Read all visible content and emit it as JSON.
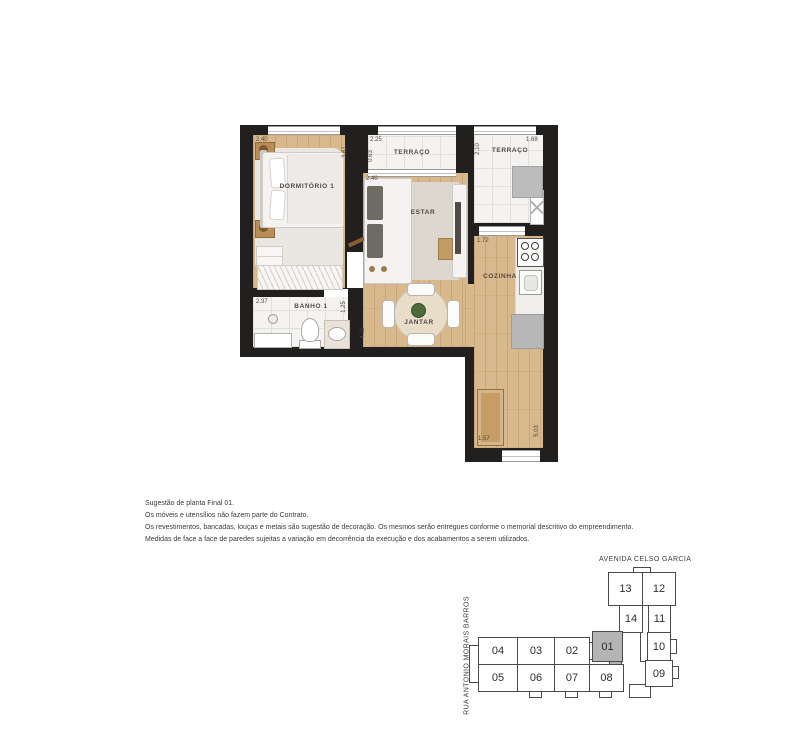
{
  "floor_plan": {
    "rooms": [
      "DORMITÓRIO 1",
      "TERRAÇO",
      "TERRAÇO",
      "ESTAR",
      "COZINHA",
      "BANHO 1",
      "JANTAR"
    ],
    "dimensions": [
      "2.40",
      "3.61",
      "2.25",
      "0.63",
      "2.40",
      "2.10",
      "1.68",
      "1.72",
      "2.37",
      "1.25",
      "4.11",
      "1.57",
      "5.03"
    ]
  },
  "disclaimer": {
    "lines": [
      "Sugestão de planta Final 01.",
      "Os móveis e utensílios não fazem parte do Contrato.",
      "Os revestimentos, bancadas, louças e metais são sugestão de decoração. Os mesmos serão entregues conforme o memorial descritivo do empreendimento.",
      "Medidas de face a face de paredes sujeitas a variação em decorrência da execução e dos acabamentos a serem utilizados."
    ]
  },
  "key_plan": {
    "street_top": "AVENIDA CELSO GARCIA",
    "street_left": "RUA ANTONIO MORAIS BARROS",
    "highlighted_unit": "01",
    "units": [
      "13",
      "12",
      "14",
      "11",
      "01",
      "10",
      "04",
      "03",
      "02",
      "05",
      "06",
      "07",
      "08",
      "09"
    ]
  },
  "colors": {
    "wall": "#21201e",
    "wood_floor": "#d8b88c",
    "tile_floor": "#f4f3f1",
    "highlight_unit": "#b4b4b4",
    "plant": "#4c6b38"
  }
}
